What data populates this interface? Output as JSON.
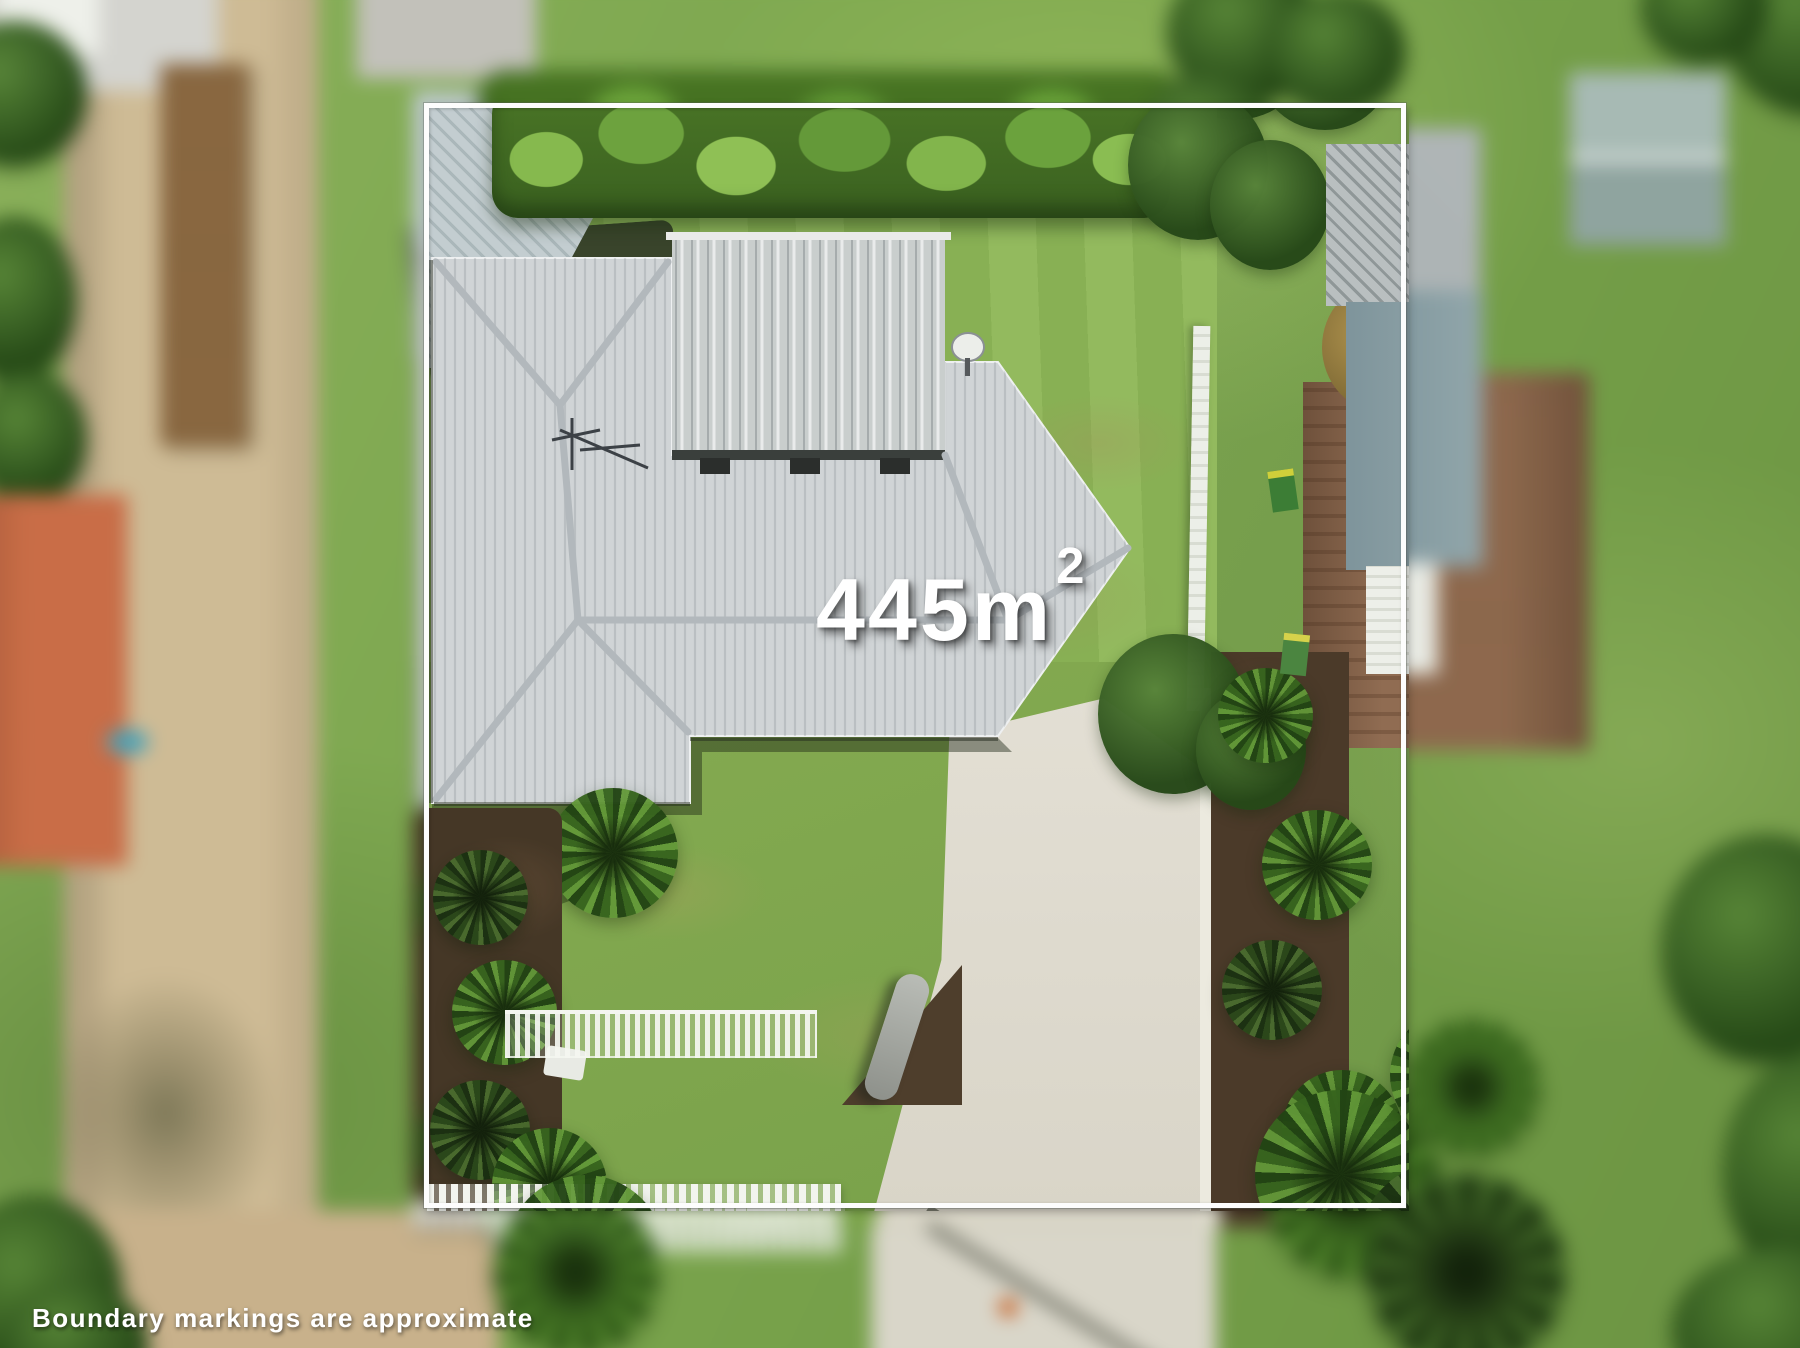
{
  "overlay": {
    "area_label": {
      "value": "445m",
      "superscript": "2",
      "full": "445m²"
    },
    "disclaimer": "Boundary markings are approximate",
    "boundary_color": "#fdfdfd",
    "text_color": "#ffffff"
  },
  "scene": {
    "palette": {
      "lawn": "#85ab51",
      "hedge": "#3f6a22",
      "roof_tiles": "#d0d4d6",
      "roof_metal": "#c9cecd",
      "driveway_concrete": "#dcd8cc",
      "side_road_gravel": "#cdbb97",
      "neighbor_roof_red": "#c9734e",
      "neighbor_roof_brown": "#906c52",
      "garden_mulch": "#4b3a29",
      "fence_white": "#f2f4ee"
    }
  }
}
